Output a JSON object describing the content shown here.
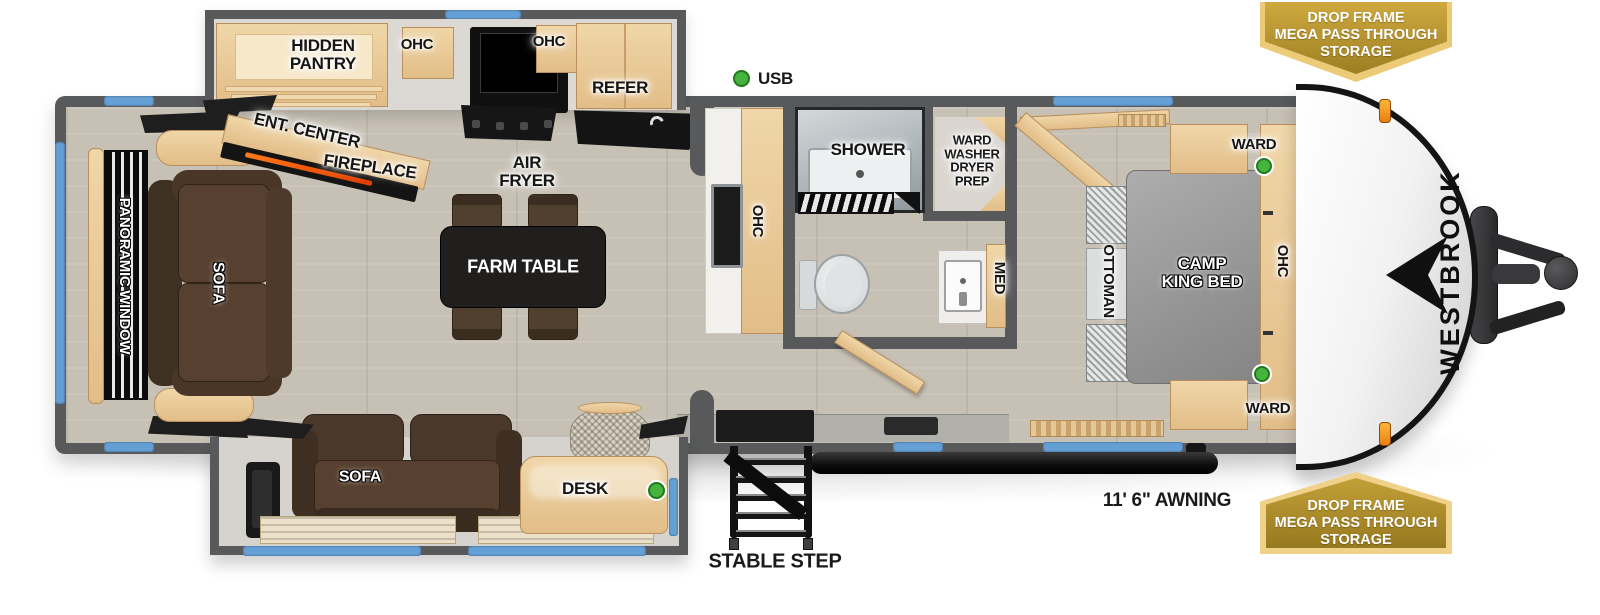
{
  "brand": {
    "name": "WESTBROOK"
  },
  "badges": {
    "top": {
      "text": "DROP FRAME\nMEGA PASS THROUGH\nSTORAGE"
    },
    "bottom": {
      "text": "DROP FRAME\nMEGA PASS THROUGH\nSTORAGE"
    }
  },
  "callouts": {
    "usb": "USB",
    "awning_length": "11' 6\" AWNING",
    "stable_step": "STABLE STEP"
  },
  "rooms": {
    "kitchen": {
      "hidden_pantry": "HIDDEN\nPANTRY",
      "ohc_left": "OHC",
      "ohc_right": "OHC",
      "refer": "REFER",
      "air_fryer": "AIR\nFRYER",
      "ent_center": "ENT. CENTER",
      "fireplace": "FIREPLACE",
      "ohc_island": "OHC"
    },
    "living": {
      "panoramic_window": "PANORAMIC WINDOW",
      "sofa_rear": "SOFA",
      "farm_table": "FARM TABLE",
      "sofa_slide": "SOFA",
      "desk": "DESK"
    },
    "bath": {
      "shower": "SHOWER",
      "ward_washer_dryer_prep": "WARD\nWASHER\nDRYER\nPREP",
      "med": "MED"
    },
    "bedroom": {
      "ottoman": "OTTOMAN",
      "bed": "CAMP\nKING BED",
      "ward_top": "WARD",
      "ward_bottom": "WARD",
      "ohc": "OHC"
    }
  },
  "colors": {
    "wall_gray": "#58595b",
    "window_blue": "#64a0d6",
    "usb_green": "#45b33c",
    "badge_gold": "#b2912f",
    "sofa_brown": "#57402f",
    "bed_gray": "#9a9a9a"
  }
}
